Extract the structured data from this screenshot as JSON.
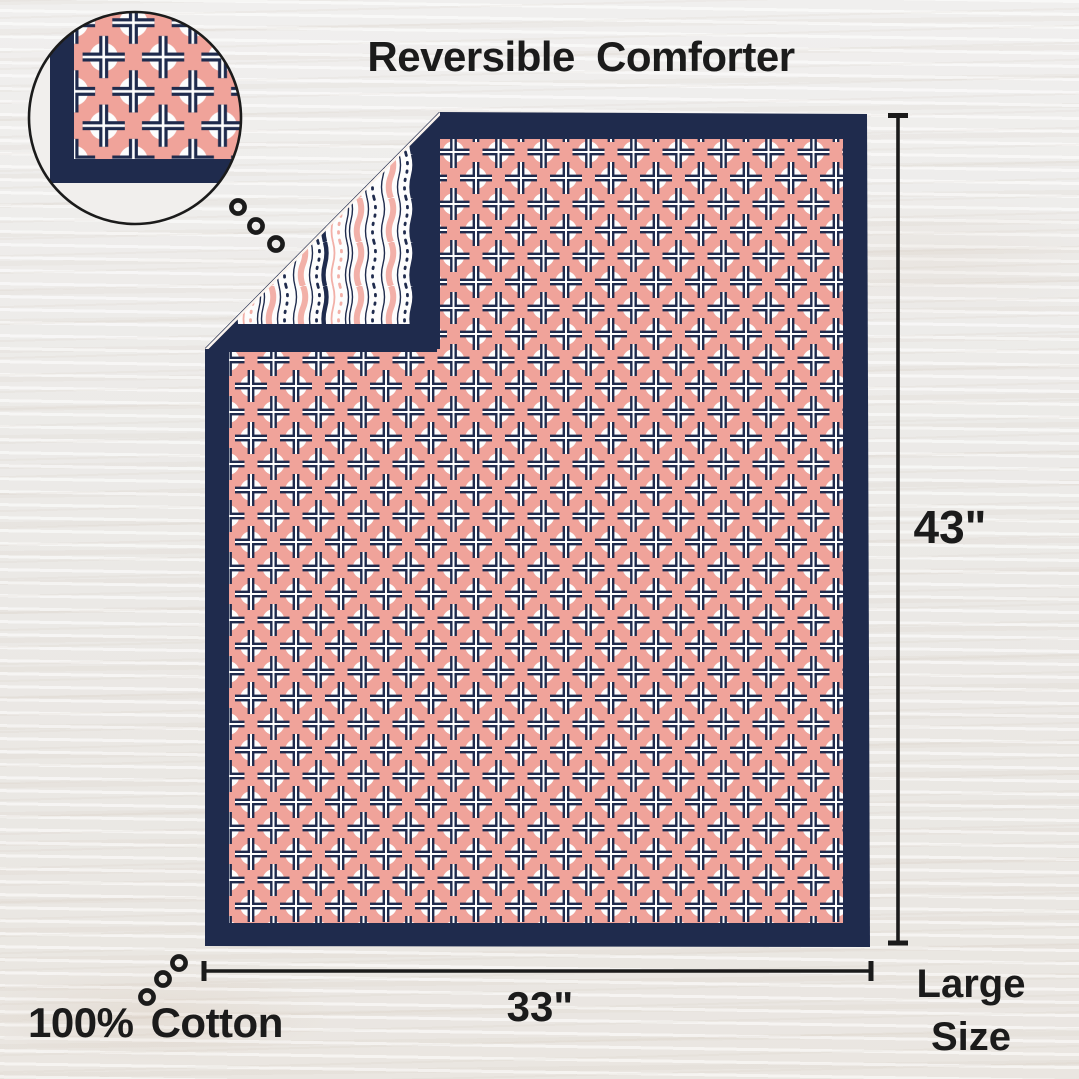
{
  "title": "Reversible Comforter",
  "dimensions": {
    "height_label": "43\"",
    "width_label": "33\""
  },
  "size_label": {
    "line1": "Large",
    "line2": "Size"
  },
  "material_label": "100% Cotton",
  "comforter": {
    "front_pattern": "coral ground with white circles and navy double-line crosses",
    "back_pattern": "white ground with vertical navy and coral wavy, dotted stripes",
    "border": "navy binding",
    "detail_magnifier": "magnified corner of front pattern",
    "stitch_dots": "o o o"
  },
  "colors": {
    "navy": "#1f2b4d",
    "coral": "#f0a39a",
    "stripe_pink": "#f2b0a8",
    "white": "#fdfdfd",
    "background": "#edecea",
    "ink": "#1b1b1b"
  }
}
